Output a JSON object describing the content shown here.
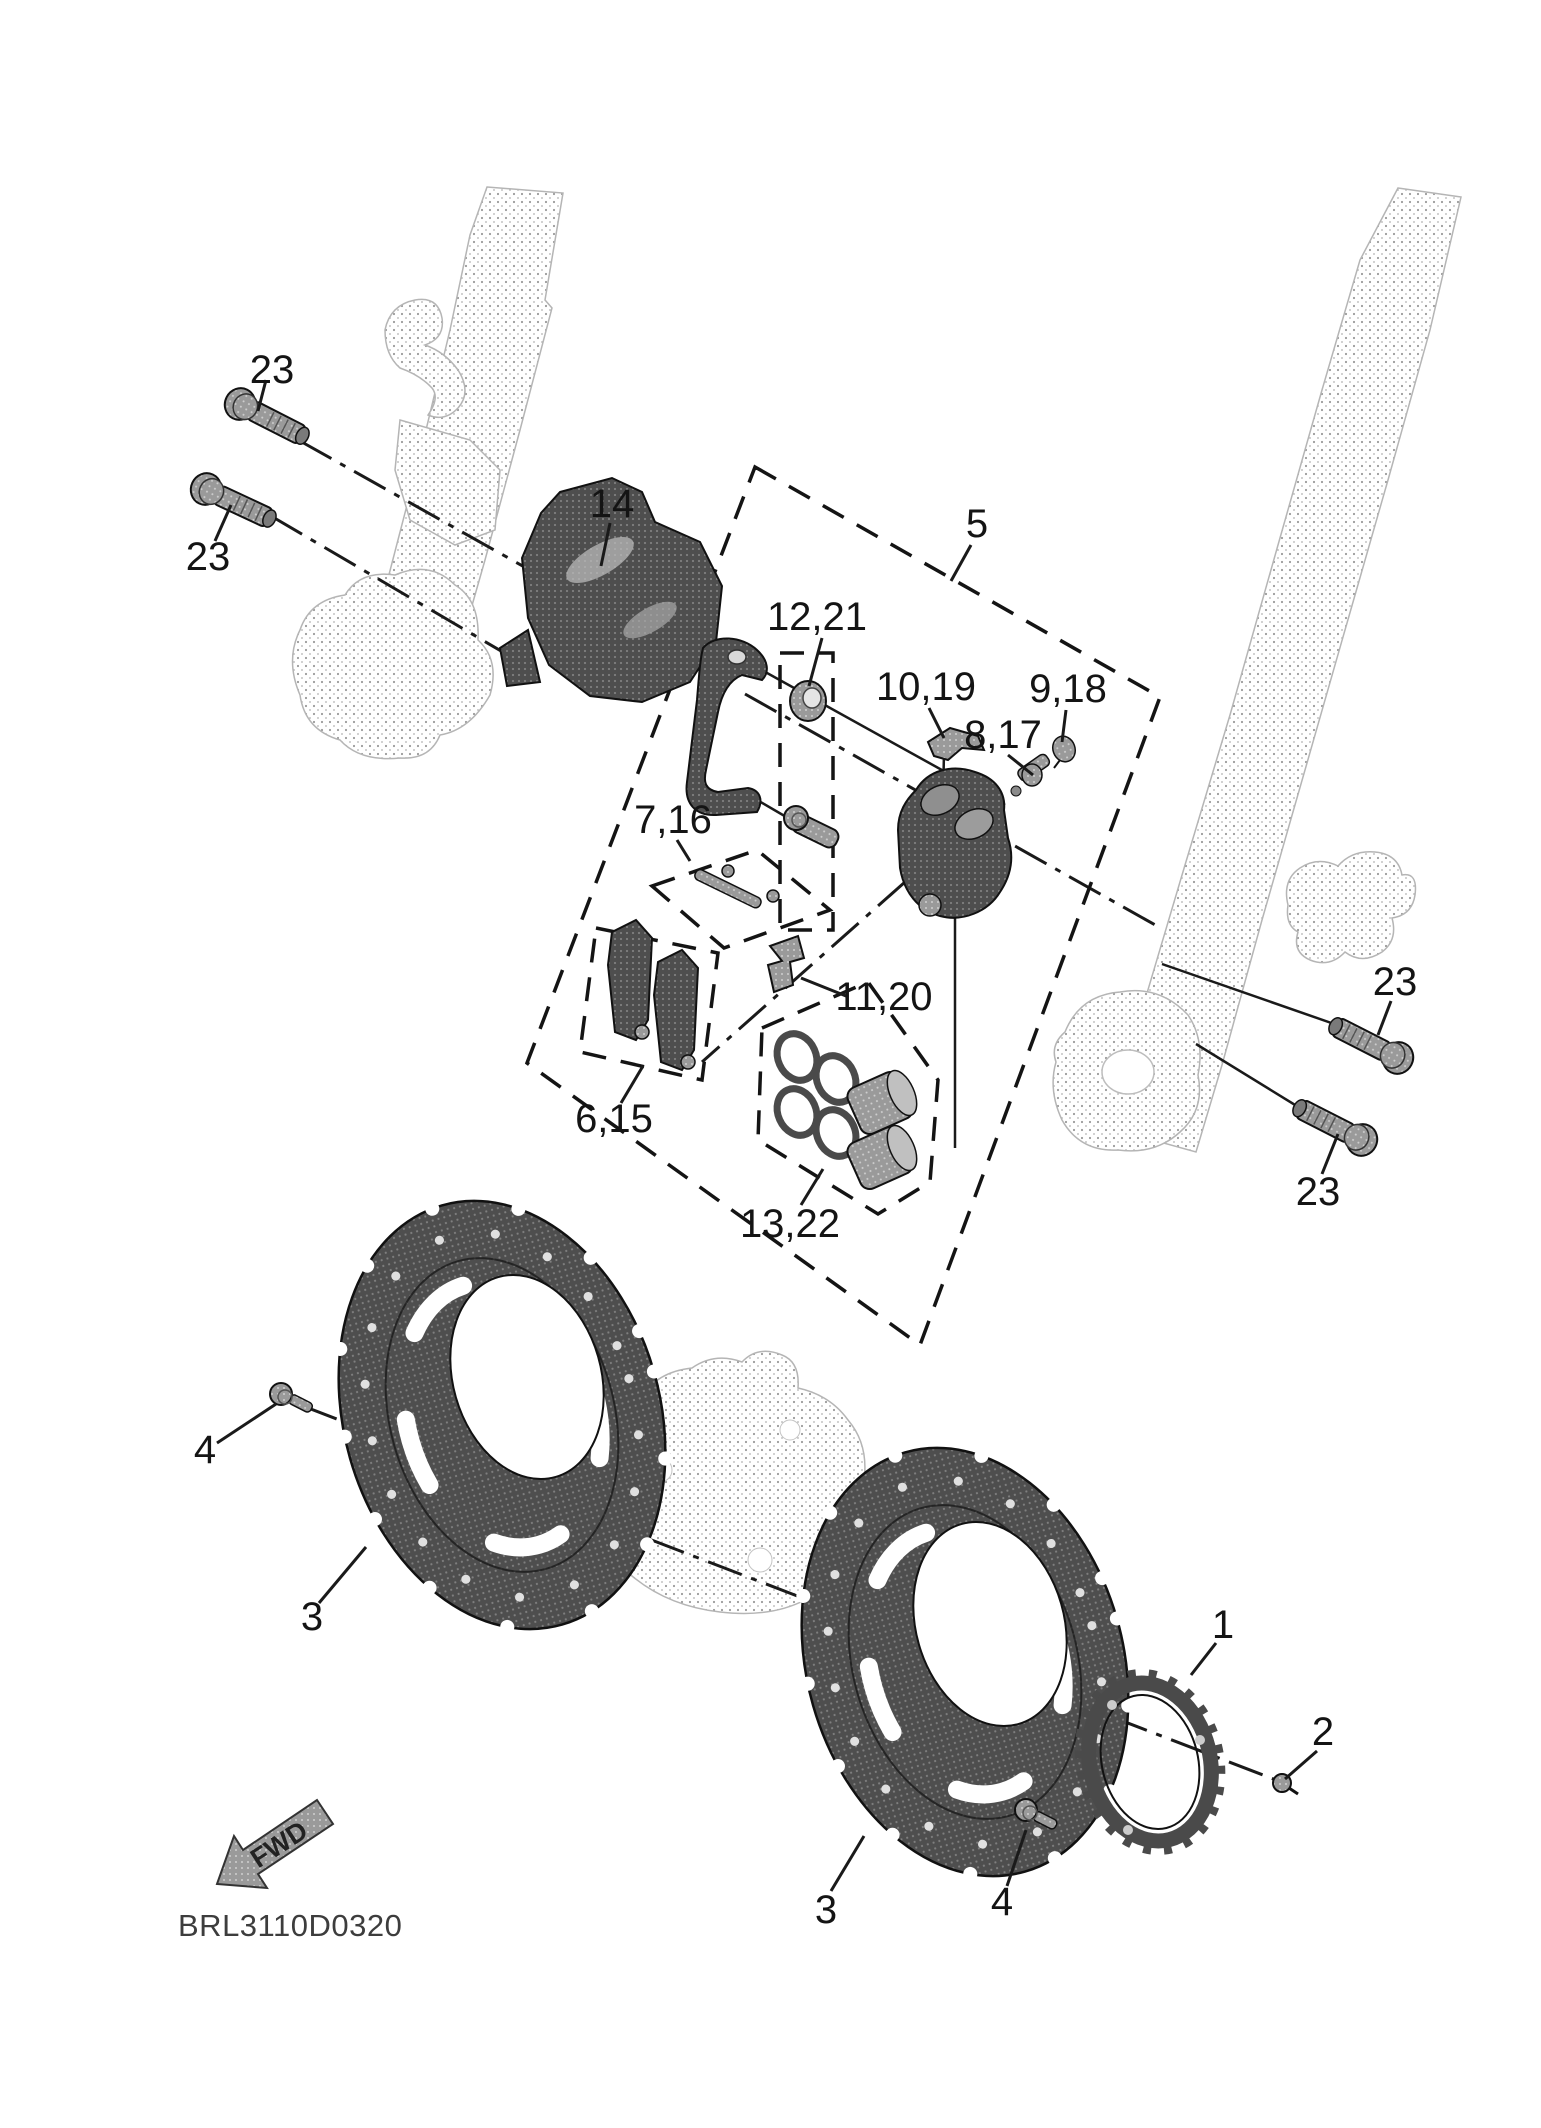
{
  "diagram": {
    "drawing_code": "BRL3110D0320",
    "fwd_label": "FWD",
    "callouts": [
      {
        "id": "bolt-23-top-left-upper",
        "text": "23"
      },
      {
        "id": "bolt-23-top-left-lower",
        "text": "23"
      },
      {
        "id": "caliper-assembly",
        "text": "14"
      },
      {
        "id": "caliper-kit-box",
        "text": "5"
      },
      {
        "id": "bushing",
        "text": "12,21"
      },
      {
        "id": "retaining-clip",
        "text": "10,19"
      },
      {
        "id": "bleed-screw-cap",
        "text": "9,18"
      },
      {
        "id": "bleed-screw",
        "text": "8,17"
      },
      {
        "id": "pad-pin-kit",
        "text": "7,16"
      },
      {
        "id": "pad-clip",
        "text": "11,20"
      },
      {
        "id": "brake-pads",
        "text": "6,15"
      },
      {
        "id": "seal-piston-kit",
        "text": "13,22"
      },
      {
        "id": "bolt-23-right-upper",
        "text": "23"
      },
      {
        "id": "bolt-23-right-lower",
        "text": "23"
      },
      {
        "id": "disc-bolt-left",
        "text": "4"
      },
      {
        "id": "brake-disc-left",
        "text": "3"
      },
      {
        "id": "sensor-rotor",
        "text": "1"
      },
      {
        "id": "sensor-rotor-screw",
        "text": "2"
      },
      {
        "id": "brake-disc-right",
        "text": "3"
      },
      {
        "id": "disc-bolt-right",
        "text": "4"
      }
    ],
    "palette": {
      "background": "#ffffff",
      "ink": "#141414",
      "ghost_part": "#a6a6a6",
      "dark_part": "#4e4e4e",
      "mid_part": "#9a9a9a"
    }
  }
}
